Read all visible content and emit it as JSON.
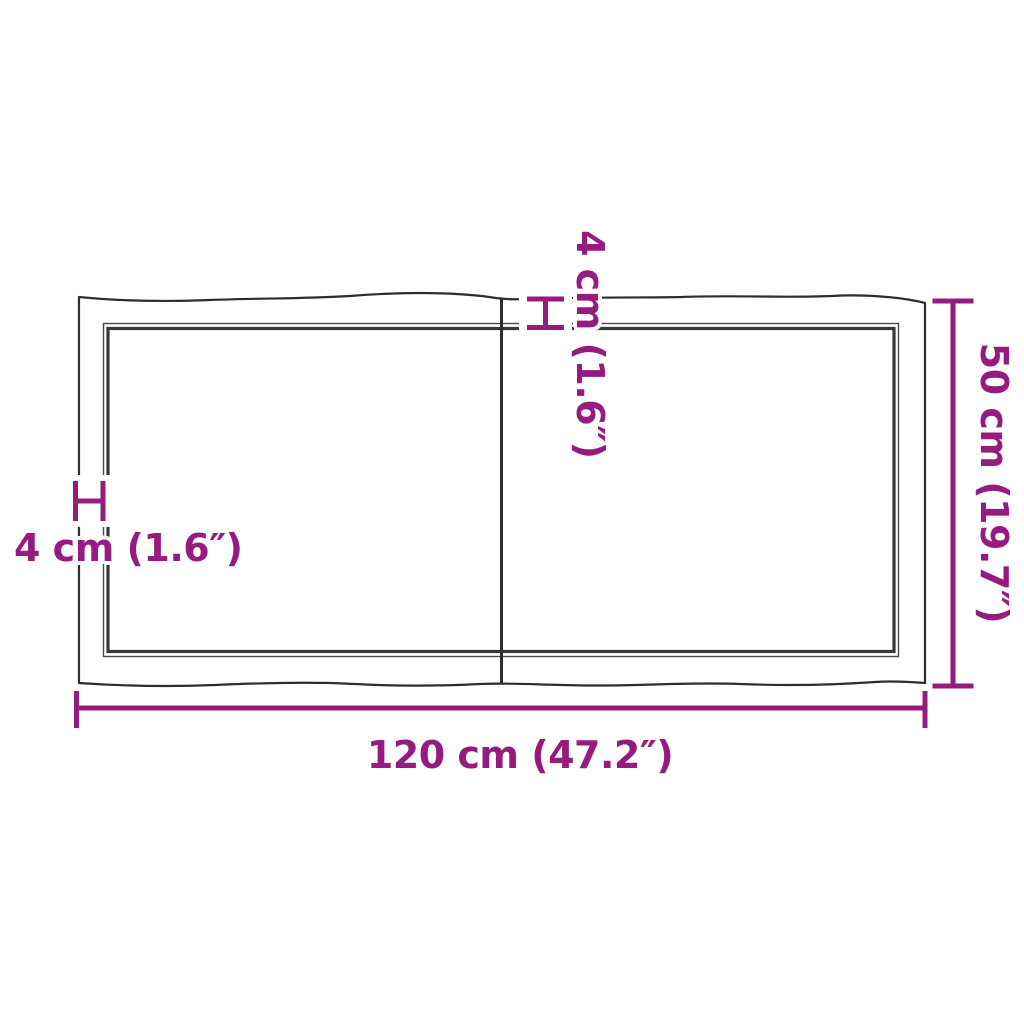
{
  "diagram": {
    "colors": {
      "accent": "#951B81",
      "outline": "#2d2d2d"
    },
    "dimensions": {
      "width_label": "120 cm (47.2″)",
      "height_label": "50 cm (19.7″)",
      "edge_left_label": "4 cm (1.6″)",
      "edge_top_label": "4 cm (1.6″)"
    }
  }
}
